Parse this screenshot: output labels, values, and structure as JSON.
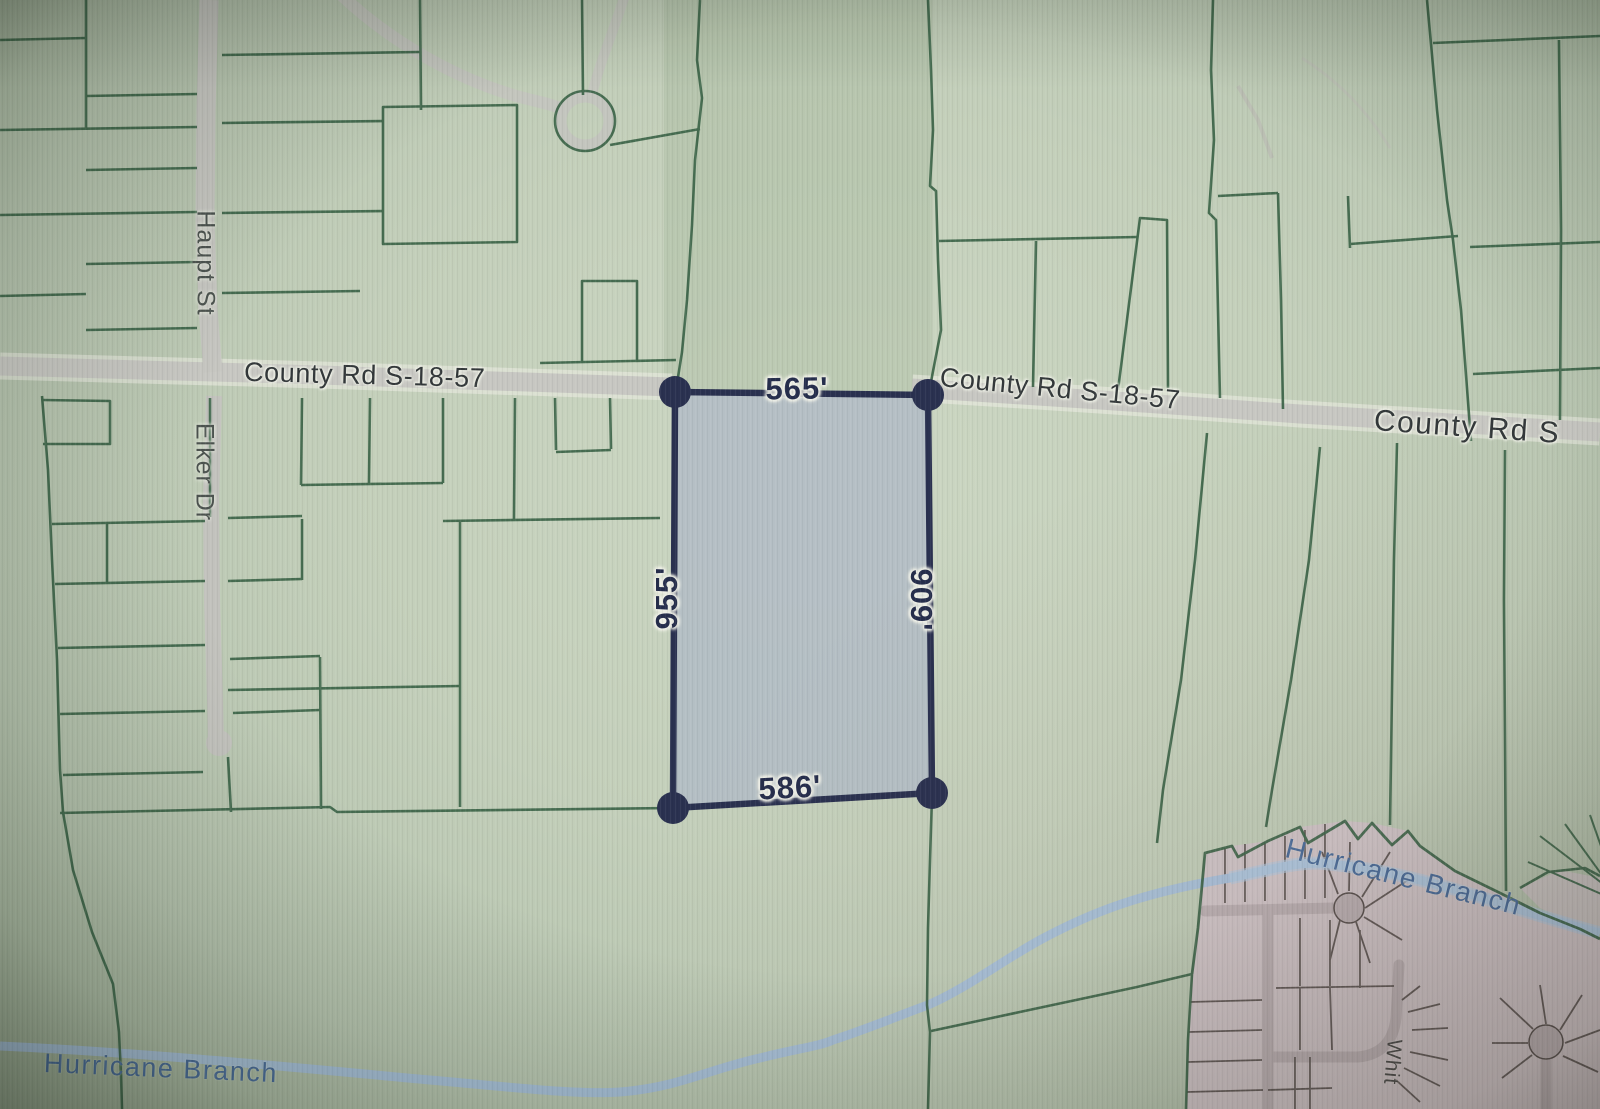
{
  "map": {
    "roads": {
      "county_rd_label_1": "County Rd S-18-57",
      "county_rd_label_2": "County Rd S-18-57",
      "county_rd_label_3": "County Rd S",
      "haupt_st_label": "Haupt St",
      "elker_dr_label": "Elker Dr",
      "subdivision_street_label": "Whit"
    },
    "water": {
      "stream_label_left": "Hurricane Branch",
      "stream_label_right": "Hurricane Branch"
    },
    "selected_parcel": {
      "top_dimension": "565'",
      "right_dimension": "909'",
      "bottom_dimension": "586'",
      "left_dimension": "955'"
    },
    "colors": {
      "parcel_outline_accent": "#2a3150",
      "parcel_fill": "#b2bcc5",
      "boundary_green": "#3d6549",
      "road_gray": "#c7c7c2",
      "water_blue": "#a3bdd6",
      "water_label_blue": "#4b6d99",
      "subdivision_fill": "#cbc1c3",
      "background_green": "#c3cfba"
    }
  }
}
